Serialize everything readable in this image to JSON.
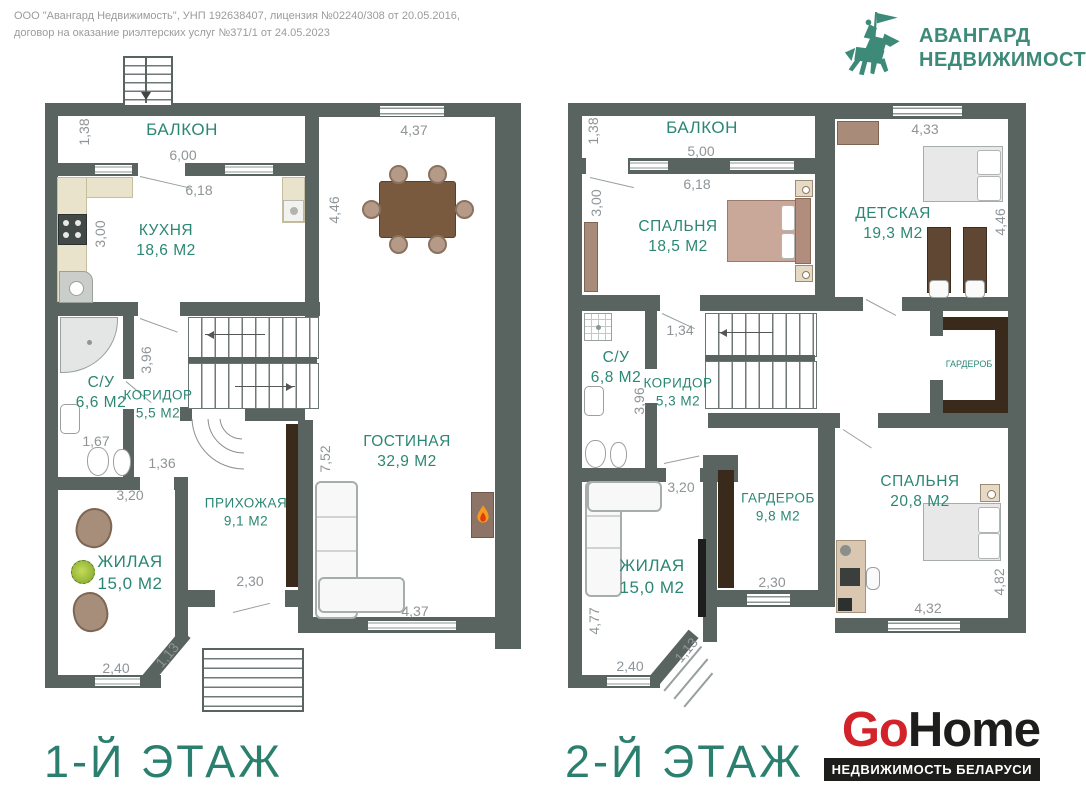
{
  "header": {
    "company_line1": "ООО \"Авангард Недвижимость\", УНП 192638407, лицензия №02240/308 от 20.05.2016,",
    "company_line2": "договор на оказание риэлтерских услуг №371/1 от 24.05.2023",
    "agency": {
      "icon": "knight-horse-icon",
      "line1": "АВАНГАРД",
      "line2": "НЕДВИЖИМОСТЬ",
      "accent_color": "#3d8a78"
    }
  },
  "floor1": {
    "title": "1-Й ЭТАЖ",
    "rooms": {
      "balcony": {
        "name": "БАЛКОН"
      },
      "kitchen": {
        "name": "КУХНЯ",
        "area": "18,6 М2"
      },
      "bathroom": {
        "name": "С/У",
        "area": "6,6 М2"
      },
      "corridor": {
        "name": "КОРИДОР",
        "area": "5,5 М2"
      },
      "living": {
        "name": "ГОСТИНАЯ",
        "area": "32,9 М2"
      },
      "hall": {
        "name": "ПРИХОЖАЯ",
        "area": "9,1 М2"
      },
      "room": {
        "name": "ЖИЛАЯ",
        "area": "15,0 М2"
      }
    },
    "dims": {
      "balcony_depth": "1,38",
      "balcony_width": "6,00",
      "kitchen_width": "6,18",
      "kitchen_depth": "3,00",
      "dining_width": "4,37",
      "dining_depth": "4,46",
      "corridor_len": "3,96",
      "bath_width": "1,67",
      "corridor_width": "1,36",
      "room_top": "3,20",
      "living_len": "7,52",
      "hall_door": "2,30",
      "room_bottom": "2,40",
      "room_diag": "1,13",
      "living_width": "4,37"
    }
  },
  "floor2": {
    "title": "2-Й ЭТАЖ",
    "rooms": {
      "balcony": {
        "name": "БАЛКОН"
      },
      "bedroom1": {
        "name": "СПАЛЬНЯ",
        "area": "18,5 М2"
      },
      "kids": {
        "name": "ДЕТСКАЯ",
        "area": "19,3 М2"
      },
      "bathroom": {
        "name": "С/У",
        "area": "6,8 М2"
      },
      "corridor": {
        "name": "КОРИДОР",
        "area": "5,3 М2"
      },
      "closet_small": {
        "name": "ГАРДЕРОБ"
      },
      "room": {
        "name": "ЖИЛАЯ",
        "area": "15,0 М2"
      },
      "closet": {
        "name": "ГАРДЕРОБ",
        "area": "9,8 М2"
      },
      "bedroom2": {
        "name": "СПАЛЬНЯ",
        "area": "20,8 М2"
      }
    },
    "dims": {
      "balcony_depth": "1,38",
      "balcony_width": "5,00",
      "bedroom1_width": "6,18",
      "bedroom1_depth": "3,00",
      "kids_width": "4,33",
      "kids_depth": "4,46",
      "corridor_top": "1,34",
      "corridor_len": "3,96",
      "corridor_bottom": "3,20",
      "room_side": "4,77",
      "room_bottom": "2,40",
      "room_diag": "1,13",
      "closet_window": "2,30",
      "bedroom2_width": "4,32",
      "bedroom2_depth": "4,82"
    }
  },
  "footer": {
    "gohome": {
      "part1": "Go",
      "part2": "Home",
      "tagline": "НЕДВИЖИМОСТЬ БЕЛАРУСИ",
      "red": "#d2232a",
      "black": "#1d1d1b"
    }
  },
  "colors": {
    "wall": "#596360",
    "room_label": "#2b8773",
    "dim_text": "#8e9497",
    "wood_dark": "#3a2a1c"
  }
}
